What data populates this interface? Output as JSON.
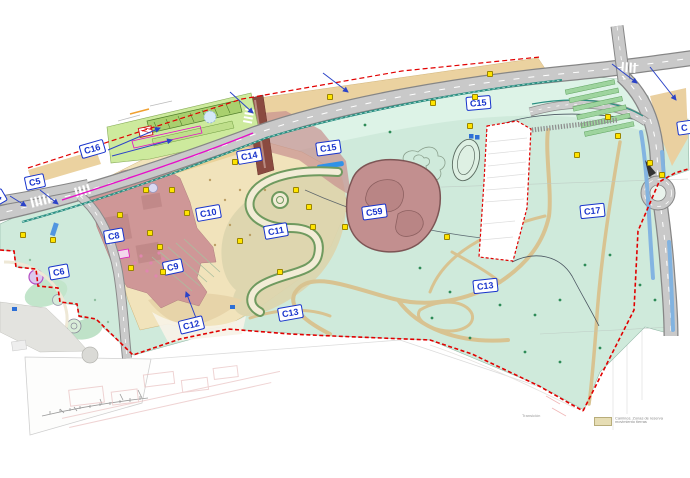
{
  "canvas": {
    "width": 690,
    "height": 478,
    "background": "#ffffff"
  },
  "zone_labels": [
    {
      "text": "C4"
    },
    {
      "text": "C5"
    },
    {
      "text": "C16"
    },
    {
      "text": "C6"
    },
    {
      "text": "C8"
    },
    {
      "text": "C9"
    },
    {
      "text": "C10"
    },
    {
      "text": "C11"
    },
    {
      "text": "C12"
    },
    {
      "text": "C13"
    },
    {
      "text": "C13"
    },
    {
      "text": "C14"
    },
    {
      "text": "C15"
    },
    {
      "text": "C15"
    },
    {
      "text": "C17"
    },
    {
      "text": "C59"
    },
    {
      "text": "C"
    }
  ],
  "legend": {
    "side_note": "Transición",
    "swatch_color": "#e6ddb4",
    "line1": "Caminos. Zonas de reserva",
    "line2": "movimiento tierras"
  },
  "colors": {
    "label_blue": "#1733cc",
    "arrow_blue": "#2b43c8",
    "boundary_red": "#e10000",
    "marker_yellow": "#ffe400",
    "legend_swatch": "#e6ddb4",
    "mint_green": "#cfeadb",
    "tan_zone": "#f1e3bb",
    "mauve_zone": "#cf9797",
    "road_gray": "#c9c9c9",
    "tram_magenta": "#e60cc8",
    "path_teal": "#2a8f82",
    "water_blue": "#7fb2e2"
  },
  "markers": [
    [
      23,
      235
    ],
    [
      53,
      240
    ],
    [
      146,
      190
    ],
    [
      172,
      190
    ],
    [
      150,
      233
    ],
    [
      131,
      268
    ],
    [
      163,
      272
    ],
    [
      187,
      213
    ],
    [
      235,
      162
    ],
    [
      240,
      241
    ],
    [
      296,
      190
    ],
    [
      309,
      207
    ],
    [
      313,
      227
    ],
    [
      345,
      227
    ],
    [
      330,
      97
    ],
    [
      433,
      103
    ],
    [
      470,
      126
    ],
    [
      475,
      97
    ],
    [
      490,
      74
    ],
    [
      447,
      237
    ],
    [
      577,
      155
    ],
    [
      608,
      117
    ],
    [
      618,
      136
    ],
    [
      650,
      163
    ],
    [
      662,
      175
    ],
    [
      280,
      272
    ],
    [
      160,
      247
    ],
    [
      120,
      215
    ]
  ],
  "arrows": [
    [
      108,
      150,
      160,
      128
    ],
    [
      112,
      156,
      172,
      140
    ],
    [
      40,
      190,
      58,
      204
    ],
    [
      10,
      196,
      26,
      206
    ],
    [
      230,
      92,
      253,
      113
    ],
    [
      323,
      73,
      348,
      92
    ],
    [
      612,
      64,
      637,
      83
    ],
    [
      650,
      67,
      676,
      100
    ],
    [
      196,
      318,
      186,
      292
    ]
  ]
}
